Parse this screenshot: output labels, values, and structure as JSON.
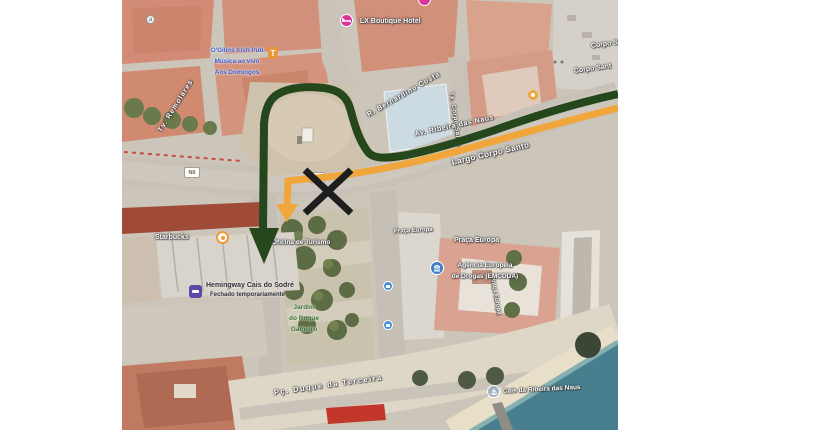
{
  "map_area": {
    "description": "Satellite view of Praça Duque da Terceira / Cais do Sodré riverfront, Lisbon, with route annotations",
    "left_px": 122,
    "width_px": 496,
    "height_px": 430
  },
  "street_labels": {
    "tv_remolares": "Tv. Remolares",
    "r_bernardino_costa": "R. Bernardino Costa",
    "tv_corpo_santo": "Tv. Corpo Santo",
    "av_ribeira_das_naus": "Av. Ribeira das Naus",
    "largo_corpo_santo": "Largo Corpo Santo",
    "corpo_santo_upper": "Corpo S",
    "corpo_santo_lower": "Corpo Sant",
    "praca_europa_small": "Praça Europa",
    "praca_europa_large": "Praça Europa",
    "praca_europa_vertical": "Praça Europa",
    "pc_duque_da_terceira": "Pç. Duque da Terceira",
    "n6_west": "N6",
    "n6_center": "N6"
  },
  "poi_labels": {
    "ogilins_line1": "O'Gilins Irish Pub",
    "ogilins_line2": "Música ao vivo",
    "ogilins_line3": "Aos Domingos",
    "lx_boutique_hotel": "LX Boutique Hotel",
    "starbucks": "Starbucks",
    "oficina_de_turismo": "Oficina de Turismo",
    "hemingway_name": "Hemingway Cais do Sodré",
    "hemingway_status": "Fechado temporariamente",
    "jardim_line1": "Jardim",
    "jardim_line2": "do Roque",
    "jardim_line3": "Gameiro",
    "emcdda_line1": "Agência Europeia",
    "emcdda_line2": "de Drogas (EMCDDA)",
    "cais_da_ribeira_das_naus": "Cais da Ribeira das Naus",
    "a_badge": "a"
  },
  "route": {
    "green_color": "#24471c",
    "orange_color": "#f0a63a",
    "x_color": "#1d1d1d"
  }
}
